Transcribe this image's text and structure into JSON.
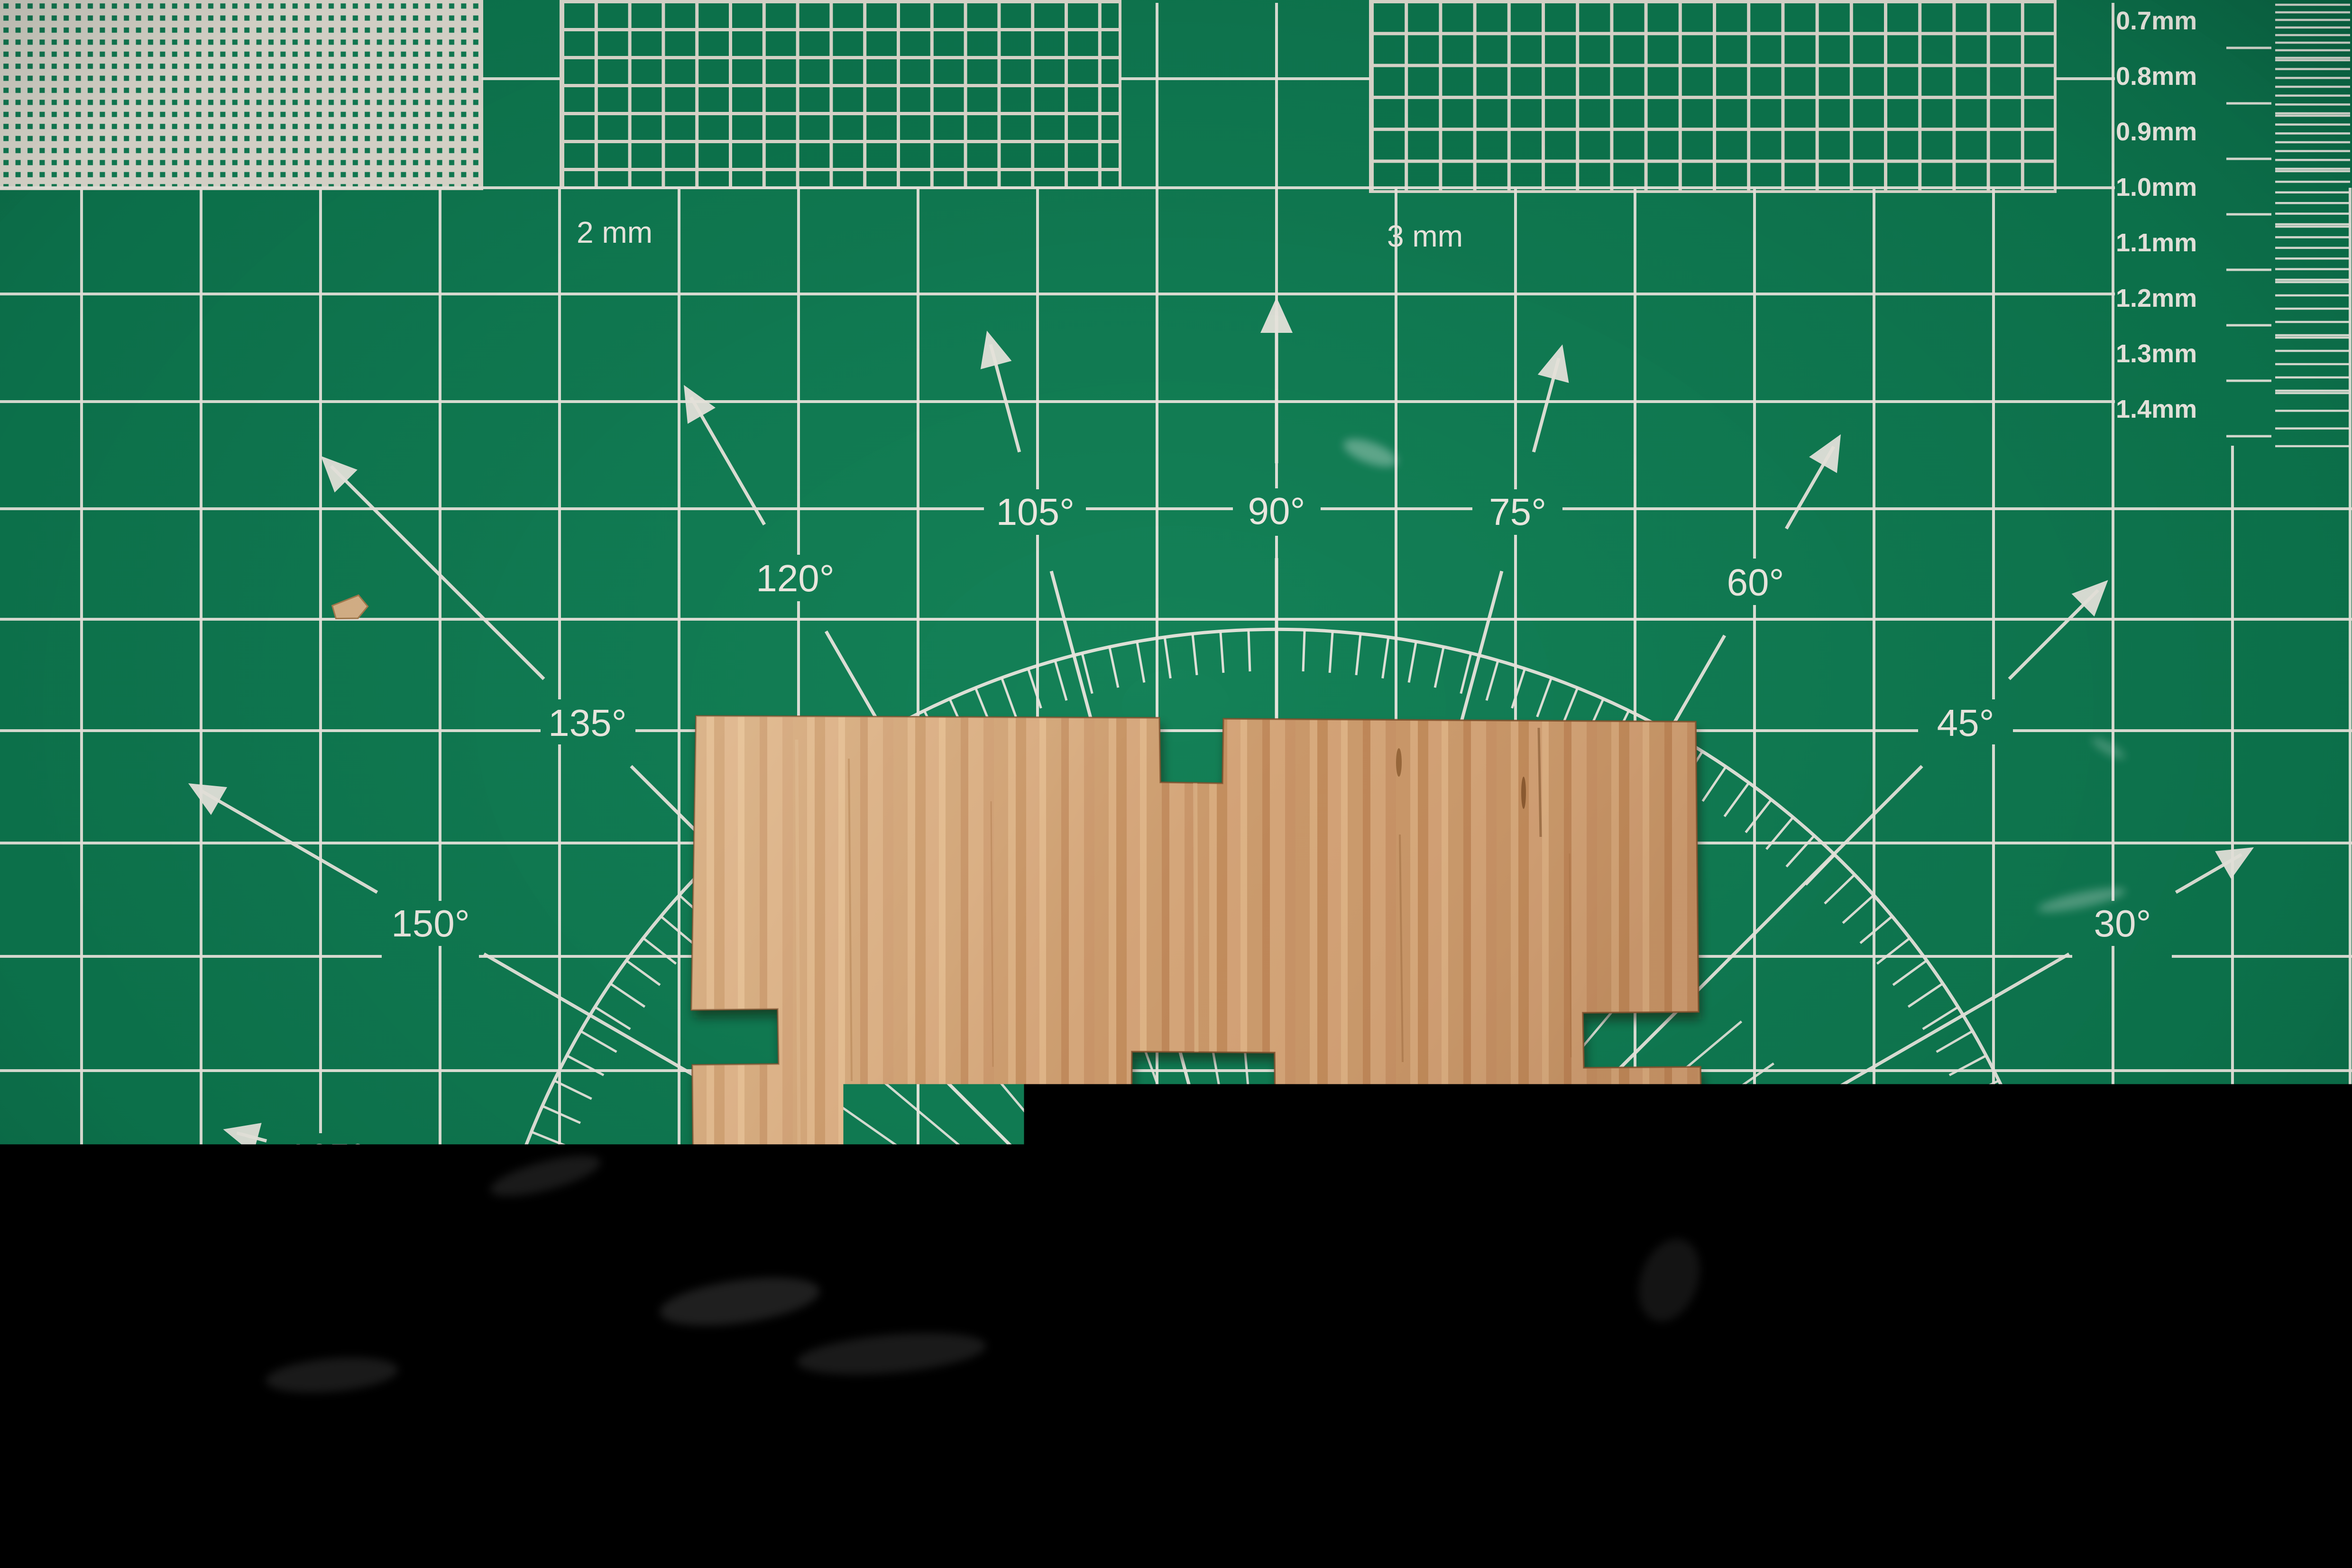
{
  "scene": {
    "description": "Photograph of a laser-cut plywood plate with finger-joint notches lying on a green self-healing cutting mat"
  },
  "mat": {
    "ruler_numbers": [
      "4",
      "5",
      "6",
      "7",
      "8",
      "9",
      "10",
      "11",
      "12",
      "13",
      "14",
      "15",
      "16",
      "17",
      "18",
      "19",
      "20",
      "21",
      "22",
      "23"
    ],
    "angle_degrees": [
      15,
      30,
      45,
      60,
      75,
      90,
      105,
      120,
      135,
      150,
      165
    ],
    "angle_labels": [
      "15°",
      "30°",
      "45°",
      "60°",
      "75°",
      "90°",
      "105°",
      "120°",
      "135°",
      "150°",
      "165°"
    ],
    "block_labels": {
      "two_mm": "2 mm",
      "three_mm": "3 mm"
    },
    "thickness_labels": [
      "0.7mm",
      "0.8mm",
      "0.9mm",
      "1.0mm",
      "1.1mm",
      "1.2mm",
      "1.3mm",
      "1.4mm"
    ],
    "colors": {
      "mat_green": "#0d744d",
      "mat_green_light": "#158258",
      "mat_green_dark": "#095a3c",
      "grid_white": "#e9e6de",
      "wood_tan": "#cb9d73",
      "wood_grain_dark": "#a9713e",
      "wood_grain_light": "#e3c096",
      "table_dark": "#190f09",
      "chip_tan": "#d6b187"
    }
  }
}
